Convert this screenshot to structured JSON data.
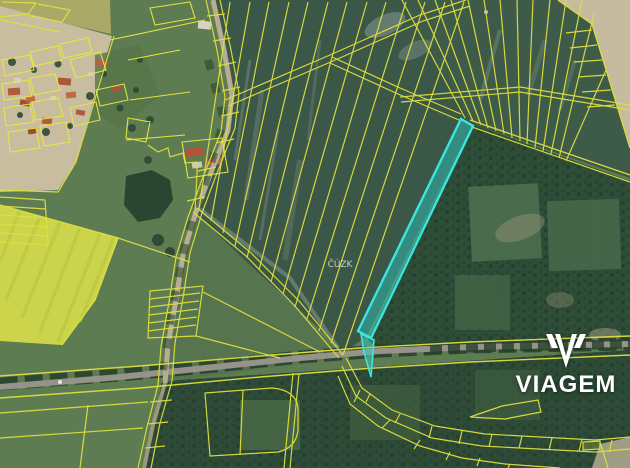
{
  "map": {
    "watermark_text": "ČÚZK",
    "highlight_parcel": {
      "points_main": "461,119 473,126 371,338 358,331",
      "points_tail": "361,334 374,340 371,377 364,352",
      "fill": "#2ed3cf",
      "fill_opacity": "0.42",
      "stroke": "#3ae6df",
      "stroke_width": "2.4"
    },
    "colors": {
      "parcel_line": "#dfdf3e",
      "village_line": "#e9e93f",
      "field_dark": "#3a5747",
      "field_strip_tint": "#41604b",
      "forest": "#2f4e38",
      "forest_band": "#2d4b36",
      "grass": "#5e7c52",
      "grass_mid": "#56744d",
      "rapeseed": "#ccd44c",
      "bare_soil": "#c9bda0",
      "bare_soil_right": "#c6bb9e",
      "road": "#96948a"
    }
  },
  "branding": {
    "logo_text": "VIAGEM",
    "logo_color": "#ffffff"
  }
}
